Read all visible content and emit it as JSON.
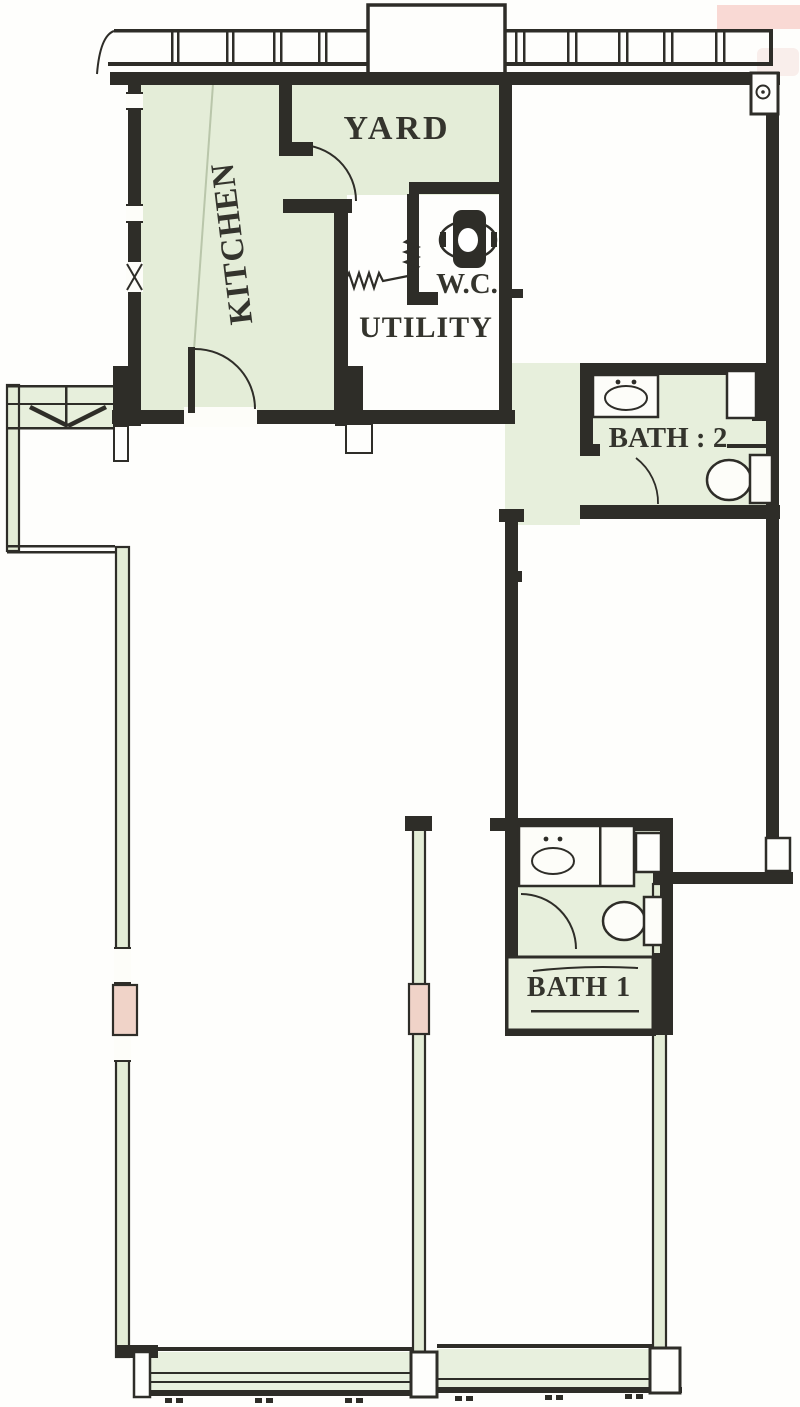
{
  "rooms": {
    "kitchen": {
      "label": "KITCHEN"
    },
    "yard": {
      "label": "YARD"
    },
    "wc": {
      "label": "W.C."
    },
    "utility": {
      "label": "UTILITY"
    },
    "bath2": {
      "label": "BATH : 2"
    },
    "bath1": {
      "label": "BATH 1"
    }
  },
  "fixtures": [
    {
      "name": "toilet",
      "room": "wc"
    },
    {
      "name": "sink",
      "room": "bath2"
    },
    {
      "name": "toilet",
      "room": "bath2"
    },
    {
      "name": "sink",
      "room": "bath1"
    },
    {
      "name": "toilet",
      "room": "bath1"
    },
    {
      "name": "bathtub",
      "room": "bath1"
    },
    {
      "name": "refuse-chute",
      "room": "service-ledge"
    },
    {
      "name": "pipe-run",
      "room": "utility"
    },
    {
      "name": "floor-trap",
      "room": "top-right-corner"
    }
  ],
  "colors": {
    "floor_fill": "#e4edd8",
    "wall": "#2e2d28",
    "paper": "#fdfdf9",
    "column_highlight": "#f0d3c8",
    "scan_artifact": "#f8cfc9"
  }
}
